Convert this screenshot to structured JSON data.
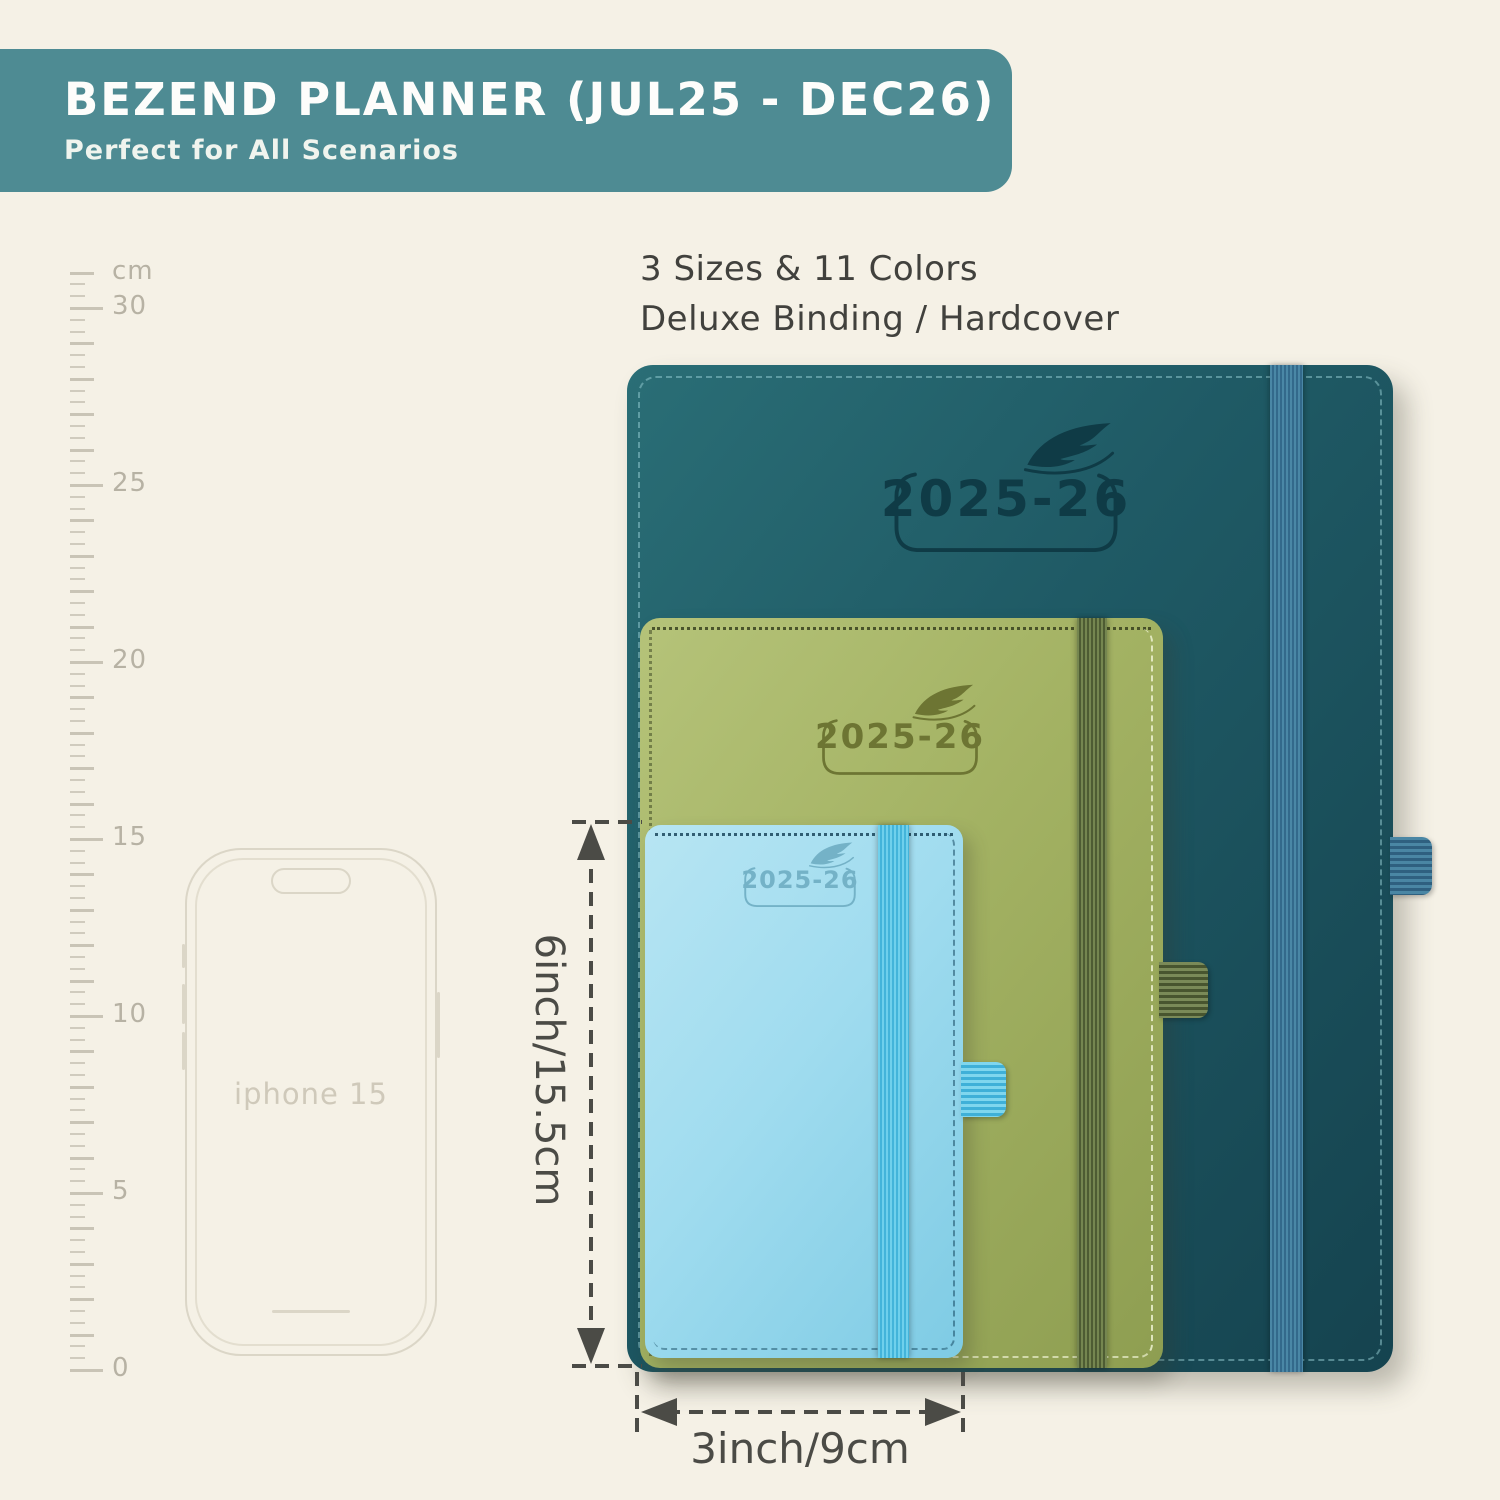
{
  "banner": {
    "title": "BEZEND PLANNER (JUL25 - DEC26)",
    "subtitle": "Perfect for All Scenarios",
    "bg_color": "#4e8b93"
  },
  "features": {
    "line1": "3 Sizes & 11 Colors",
    "line2": "Deluxe Binding / Hardcover"
  },
  "ruler": {
    "unit": "cm",
    "marks": [
      30,
      25,
      20,
      15,
      10,
      5,
      0
    ]
  },
  "phone": {
    "label": "iphone 15"
  },
  "planners": {
    "large": {
      "year": "2025-26",
      "cover_color": "#1e5a65",
      "band_color": "#3f7da0"
    },
    "medium": {
      "year": "2025-26",
      "cover_color": "#a4b364",
      "band_color": "#5d6f3e"
    },
    "small": {
      "year": "2025-26",
      "cover_color": "#a5ddef",
      "band_color": "#55c3e7"
    }
  },
  "dimensions": {
    "height_label": "6inch/15.5cm",
    "width_label": "3inch/9cm"
  },
  "colors": {
    "background": "#f5f1e6",
    "text_dark": "#41413d",
    "dimension_gray": "#4b4b46",
    "ruler_gray": "#c9c4b6",
    "phone_outline": "#dbd6c7"
  }
}
